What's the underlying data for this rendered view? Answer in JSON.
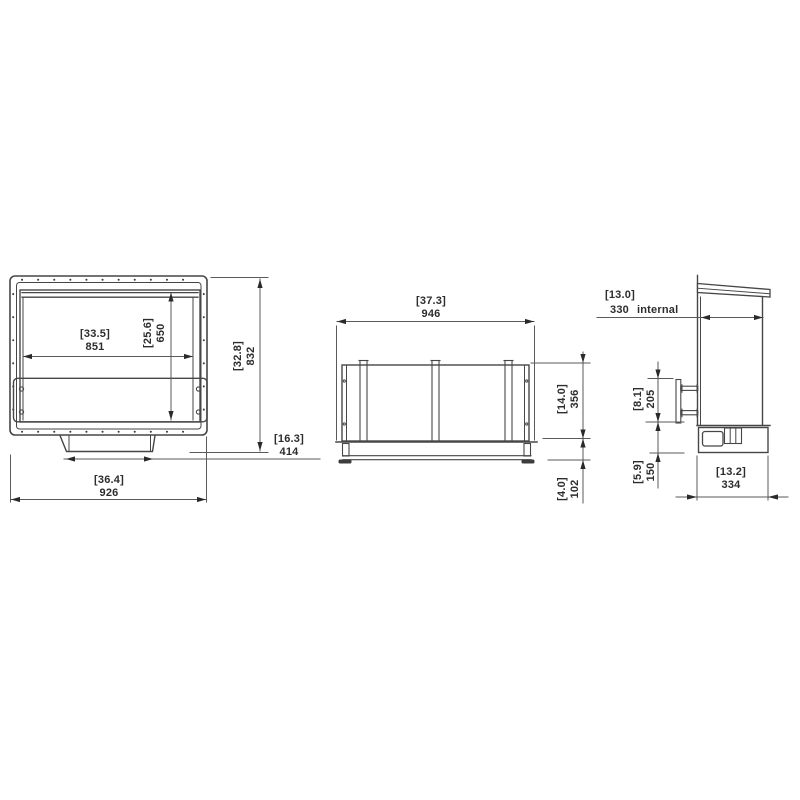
{
  "drawing": {
    "type": "technical-dimension-drawing",
    "units": "millimetres with inches in brackets",
    "colors": {
      "background": "#ffffff",
      "geometry_line": "#464646",
      "dimension_line": "#5a5a5a",
      "arrow": "#2a2a2a",
      "text": "#2d2d2d"
    },
    "views": {
      "front": {
        "name": "front-view",
        "dims": {
          "opening_width": {
            "in": "[33.5]",
            "mm": "851"
          },
          "opening_height": {
            "in": "[25.6]",
            "mm": "650"
          },
          "overall_height": {
            "in": "[32.8]",
            "mm": "832"
          },
          "tray_width": {
            "in": "[16.3]",
            "mm": "414"
          },
          "overall_width": {
            "in": "[36.4]",
            "mm": "926"
          }
        }
      },
      "rear": {
        "name": "rear-view",
        "dims": {
          "width": {
            "in": "[37.3]",
            "mm": "946"
          },
          "panel_height": {
            "in": "[14.0]",
            "mm": "356"
          },
          "base_height": {
            "in": "[4.0]",
            "mm": "102"
          }
        }
      },
      "side": {
        "name": "side-view",
        "dims": {
          "internal_depth": {
            "in": "[13.0]",
            "mm": "330",
            "label": "internal"
          },
          "bracket_height": {
            "in": "[8.1]",
            "mm": "205"
          },
          "lower_height": {
            "in": "[5.9]",
            "mm": "150"
          },
          "base_depth": {
            "in": "[13.2]",
            "mm": "334"
          }
        }
      }
    }
  }
}
